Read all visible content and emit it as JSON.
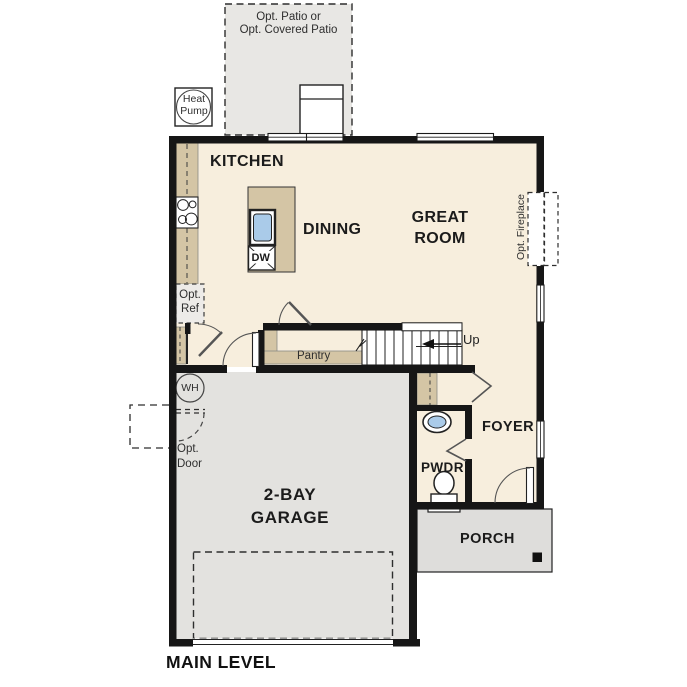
{
  "plan": {
    "title": "MAIN LEVEL",
    "rooms": {
      "kitchen": "KITCHEN",
      "dining": "DINING",
      "great_room": "GREAT\nROOM",
      "foyer": "FOYER",
      "powder": "PWDR",
      "porch": "PORCH",
      "garage": "2-BAY\nGARAGE",
      "pantry": "Pantry"
    },
    "annotations": {
      "up": "Up",
      "dw": "DW",
      "wh": "WH",
      "heat_pump": "Heat\nPump",
      "opt_ref": "Opt.\nRef",
      "opt_door": "Opt.\nDoor",
      "opt_patio": "Opt. Patio or\nOpt. Covered Patio",
      "opt_fireplace": "Opt. Fireplace"
    },
    "colors": {
      "floor": "#f7eedd",
      "casework_tan": "#d4c5a5",
      "exterior_gray": "#e3e2df",
      "sink_blue": "#aacbe9",
      "wall_black": "#161616"
    }
  }
}
